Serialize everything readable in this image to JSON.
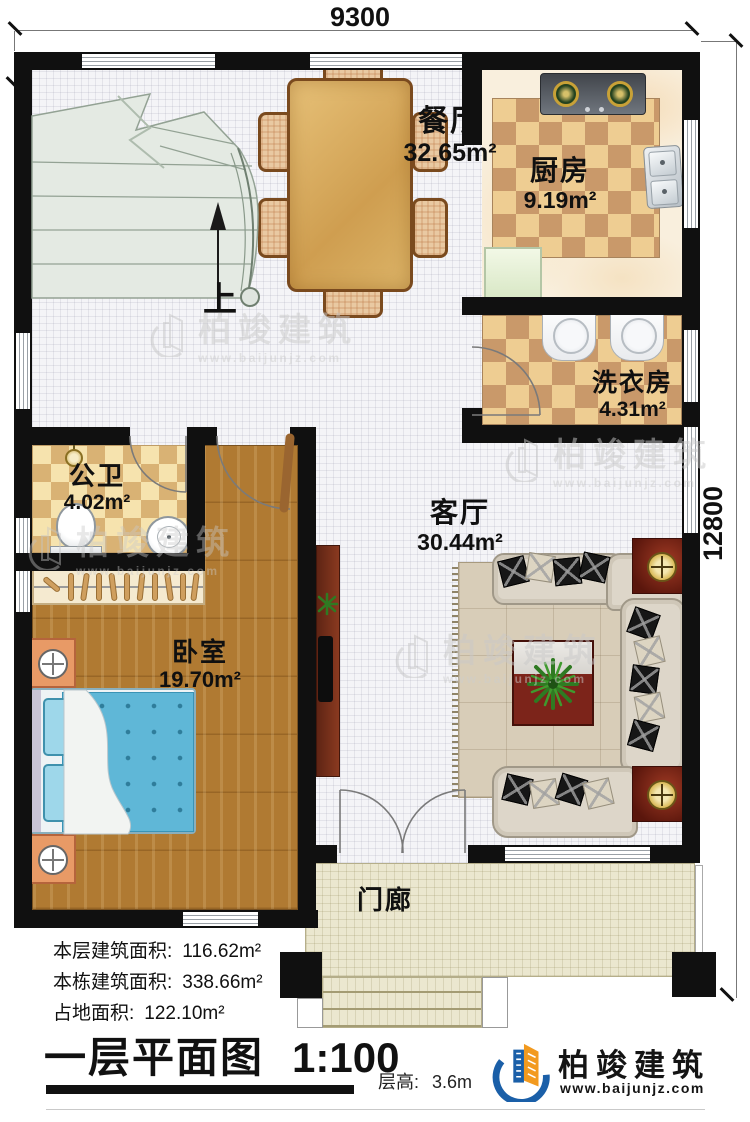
{
  "plan": {
    "dimension_top": "9300",
    "dimension_right": "12800",
    "stairs_up_label": "上",
    "rooms": {
      "dining": {
        "name": "餐厅",
        "area": "32.65m²"
      },
      "kitchen": {
        "name": "厨房",
        "area": "9.19m²"
      },
      "laundry": {
        "name": "洗衣房",
        "area": "4.31m²"
      },
      "bathroom": {
        "name": "公卫",
        "area": "4.02m²"
      },
      "living": {
        "name": "客厅",
        "area": "30.44m²"
      },
      "bedroom": {
        "name": "卧室",
        "area": "19.70m²"
      },
      "porch": {
        "name": "门廊"
      }
    }
  },
  "stats": {
    "floor_area_label": "本层建筑面积:",
    "floor_area_value": "116.62m²",
    "building_area_label": "本栋建筑面积:",
    "building_area_value": "338.66m²",
    "footprint_label": "占地面积:",
    "footprint_value": "122.10m²"
  },
  "footer": {
    "title": "一层平面图",
    "scale": "1:100",
    "floor_height_label": "层高:",
    "floor_height_value": "3.6m"
  },
  "brand": {
    "name": "柏竣建筑",
    "url": "www.baijunjz.com"
  },
  "watermark": {
    "name": "柏竣建筑",
    "url": "www.baijunjz.com"
  },
  "icons": {
    "brand_logo": "building-swoosh-icon",
    "stairs_arrow": "up-arrow-icon",
    "lamp": "crosshair-lamp-icon"
  },
  "colors": {
    "wall": "#101010",
    "checker_dark": "#c9996a",
    "checker_light": "#eecd92",
    "wood_floor": "#b07a32",
    "porch_floor": "#ebe7cf",
    "brand_blue": "#1a5fa8",
    "brand_orange": "#f29a1f"
  }
}
